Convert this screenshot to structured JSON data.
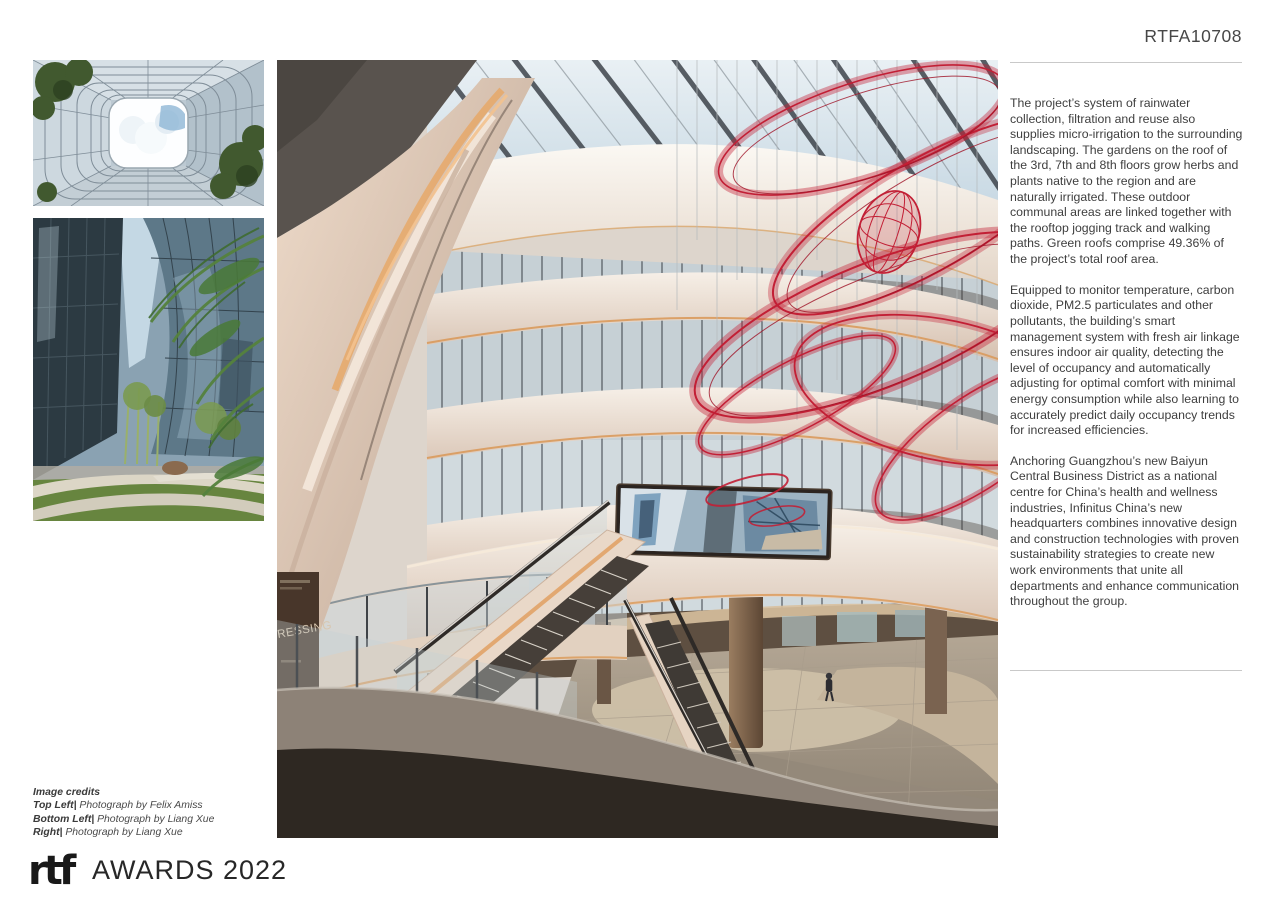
{
  "header": {
    "submission_code": "RTFA10708"
  },
  "article": {
    "paragraphs": [
      "The project’s system of rainwater collection, filtration and reuse also supplies micro-irrigation to the surrounding landscaping. The gardens on the roof of the 3rd, 7th and 8th floors grow herbs and plants native to the region and are naturally irrigated. These outdoor communal areas are linked together with the rooftop jogging track and walking paths. Green roofs comprise 49.36% of the project’s total roof area.",
      "Equipped to monitor temperature, carbon dioxide, PM2.5 particulates and other pollutants, the building’s smart management system with fresh air linkage ensures indoor air quality, detecting the level of occupancy and automatically adjusting for optimal comfort with minimal energy consumption while also learning to accurately predict daily occupancy trends for increased efficiencies.",
      "Anchoring Guangzhou’s new Baiyun Central Business District as a national centre for China’s health and wellness industries, Infinitus China’s new headquarters combines innovative design and construction technologies with proven sustainability strategies to create new work environments that unite all departments and enhance communication throughout the group."
    ]
  },
  "credits": {
    "heading": "Image credits",
    "entries": [
      {
        "label": "Top Left|",
        "text": " Photograph by Felix Amiss"
      },
      {
        "label": "Bottom Left|",
        "text": " Photograph by Liang Xue"
      },
      {
        "label": "Right|",
        "text": " Photograph by Liang Xue"
      }
    ]
  },
  "footer": {
    "logo": "rtf",
    "awards": "AWARDS 2022"
  },
  "photos": {
    "main": {
      "sign_text": "RESSING"
    }
  },
  "colors": {
    "accent_red": "#c22136",
    "warm_beige": "#e4d2c2",
    "amber_glow": "#e0a268",
    "rule_gray": "#c9c9c9"
  }
}
